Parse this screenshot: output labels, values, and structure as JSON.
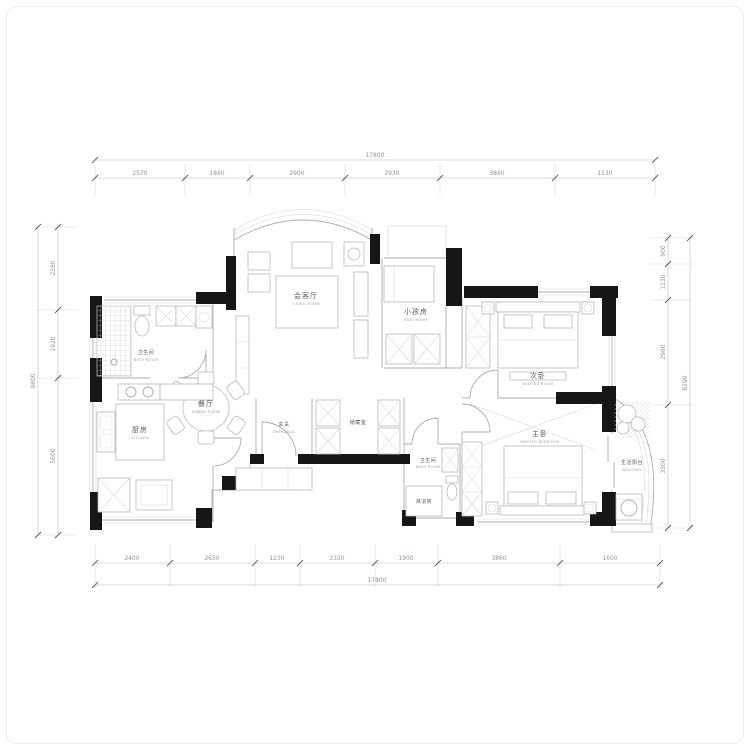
{
  "meta": {
    "drawing_type": "apartment floor plan",
    "wall_color": "#161616",
    "line_color": "#a9aeb4",
    "dim_text_color": "#8f959b"
  },
  "rooms": {
    "living": {
      "cn": "会客厅",
      "en": "LIVING ROOM"
    },
    "kids": {
      "cn": "小孩房",
      "en": "KIDS ROOM"
    },
    "second": {
      "cn": "次卧",
      "en": "SECOND ROOM"
    },
    "master": {
      "cn": "主卧",
      "en": "MASTER BEDROOM"
    },
    "balcony": {
      "cn": "生活阳台",
      "en": "BALCONY"
    },
    "bath1": {
      "cn": "卫生间",
      "en": "BATH ROOM"
    },
    "kitchen": {
      "cn": "厨房",
      "en": "KITCHEN"
    },
    "dining": {
      "cn": "餐厅",
      "en": "DINING ROOM"
    },
    "entrance": {
      "cn": "玄关",
      "en": "ENTRANCE"
    },
    "storage": {
      "cn": "储藏室"
    },
    "bath2": {
      "cn": "卫生间",
      "en": "BATH ROOM"
    },
    "shower": {
      "cn": "淋浴房"
    }
  },
  "dimensions": {
    "top": {
      "total": "17800",
      "segments": [
        "2570",
        "1860",
        "2900",
        "2930",
        "3860",
        "1130"
      ]
    },
    "bottom": {
      "total": "17800",
      "segments": [
        "2400",
        "2650",
        "1230",
        "2330",
        "1900",
        "3860",
        "1600"
      ]
    },
    "left": {
      "total": "9800",
      "segments": [
        "2280",
        "1920",
        "5600"
      ]
    },
    "right": {
      "total": "8290",
      "segments": [
        "900",
        "1130",
        "2960",
        "3300"
      ]
    }
  }
}
